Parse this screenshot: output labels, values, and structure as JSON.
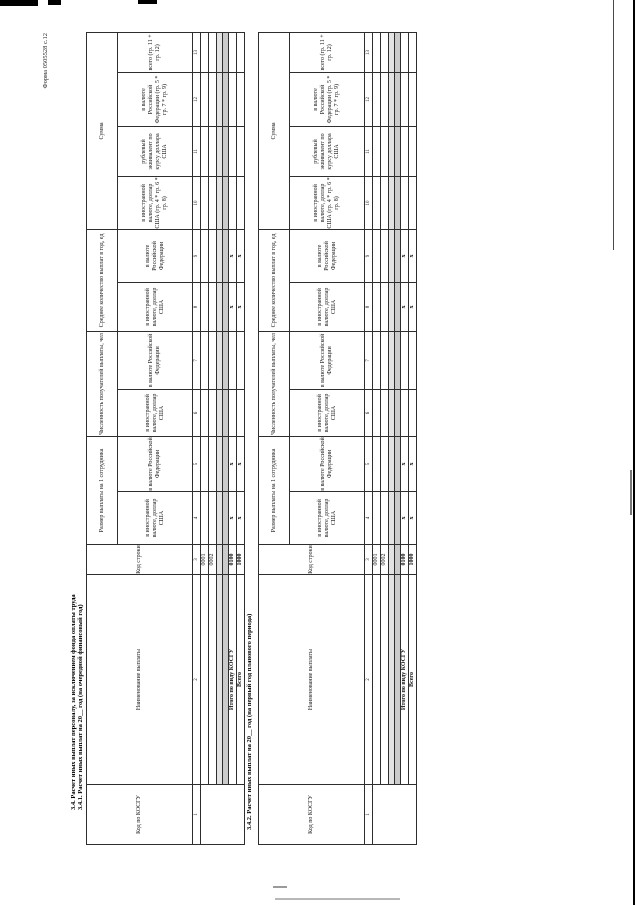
{
  "form_label": "Форма 0505528 с.12",
  "section_341": {
    "title_main": "3.4. Расчет иных выплат персоналу, за исключением фонда оплаты труда",
    "title_sub": "3.4.1. Расчет иных выплат на 20__ год (на очередной финансовый год)"
  },
  "section_342": {
    "title_sub": "3.4.2. Расчет иных выплат на 20__ год (на первый год планового периода)"
  },
  "table": {
    "headers": {
      "kosgu_code": "Код по КОСГУ",
      "payment_name": "Наименование выплаты",
      "line_code": "Код строки",
      "payment_size_per_employee": "Размер выплаты на 1 сотрудника",
      "recipients_count": "Численность получателей выплаты, чел",
      "avg_payments_per_year": "Среднее количество выплат в год, ед",
      "sum": "Сумма",
      "in_foreign_currency_usd": "в иностранной валюте, доллар США",
      "in_rf_currency": "в валюте Российской Федерации",
      "sum_in_foreign_currency": "в иностранной валюте, доллар США (гр. 4 * гр. 6 * гр. 8)",
      "ruble_equivalent": "рублевый эквивалент по курсу доллара США",
      "sum_in_rf_currency": "в валюте Российской Федерации (гр. 5 * гр. 7 * гр. 9)",
      "total": "всего (гр. 11 + гр. 12)"
    },
    "column_numbers": [
      "1",
      "2",
      "3",
      "4",
      "5",
      "6",
      "7",
      "8",
      "9",
      "10",
      "11",
      "12",
      "13"
    ],
    "rows": {
      "r1": {
        "line_code": "0001"
      },
      "r2": {
        "line_code": "0002"
      },
      "total_kosgu": {
        "label": "Итого по виду КОСГУ",
        "line_code": "0100"
      },
      "total": {
        "label": "Всего",
        "line_code": "1000"
      }
    },
    "x_mark": "x"
  }
}
